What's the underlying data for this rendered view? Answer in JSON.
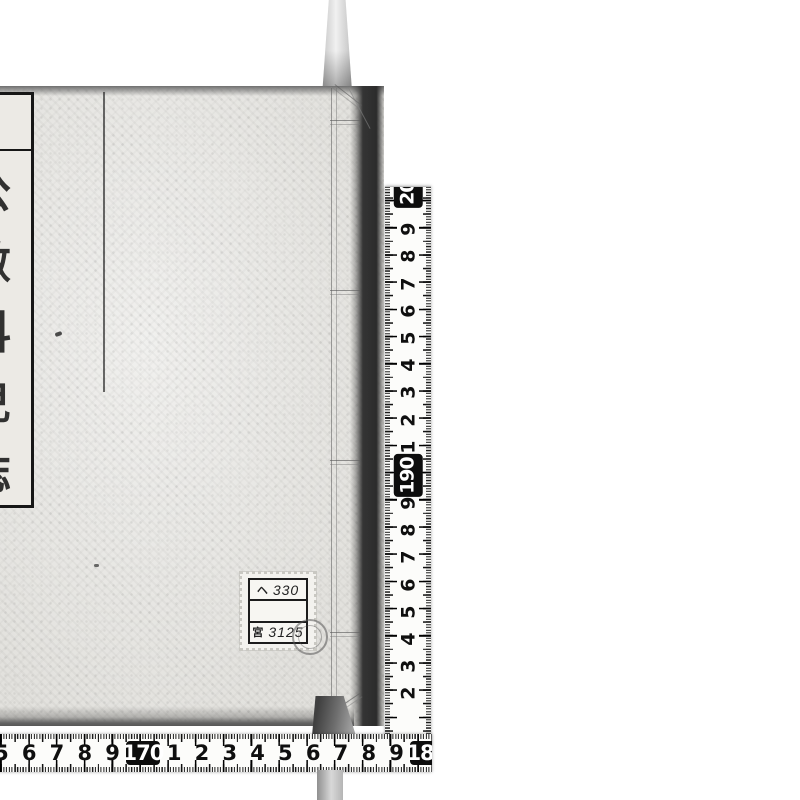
{
  "book": {
    "title_slip": {
      "header_chars": [
        "學",
        "務"
      ],
      "characters": [
        "公",
        "數",
        "科",
        "兒",
        "誌"
      ]
    },
    "call_number_label": {
      "row1_prefix": "ヘ",
      "row1_number": "330",
      "row2": "",
      "row3_prefix": "宮",
      "row3_number": "3125"
    }
  },
  "rulers": {
    "vertical": {
      "unit": "cm",
      "numbers": [
        {
          "t": "200",
          "box": true
        },
        "9",
        "8",
        "7",
        "6",
        "5",
        "4",
        "3",
        "2",
        "1",
        {
          "t": "190",
          "box": true
        },
        "9",
        "8",
        "7",
        "6",
        "5",
        "4",
        "3",
        "2"
      ]
    },
    "horizontal": {
      "unit": "cm",
      "numbers": [
        "5",
        "6",
        "7",
        "8",
        "9",
        {
          "t": "170",
          "box": true
        },
        "1",
        "2",
        "3",
        "4",
        "5",
        "6",
        "7",
        "8",
        "9",
        {
          "t": "180",
          "box": true
        }
      ]
    }
  },
  "colors": {
    "background": "#ffffff",
    "cover": "#e2e1dd",
    "edge_shadow": "#2c2c2c",
    "tape": "#fcfcfa",
    "tape_mark": "#0f0f0f",
    "tape_box_bg": "#0d0d0d"
  }
}
